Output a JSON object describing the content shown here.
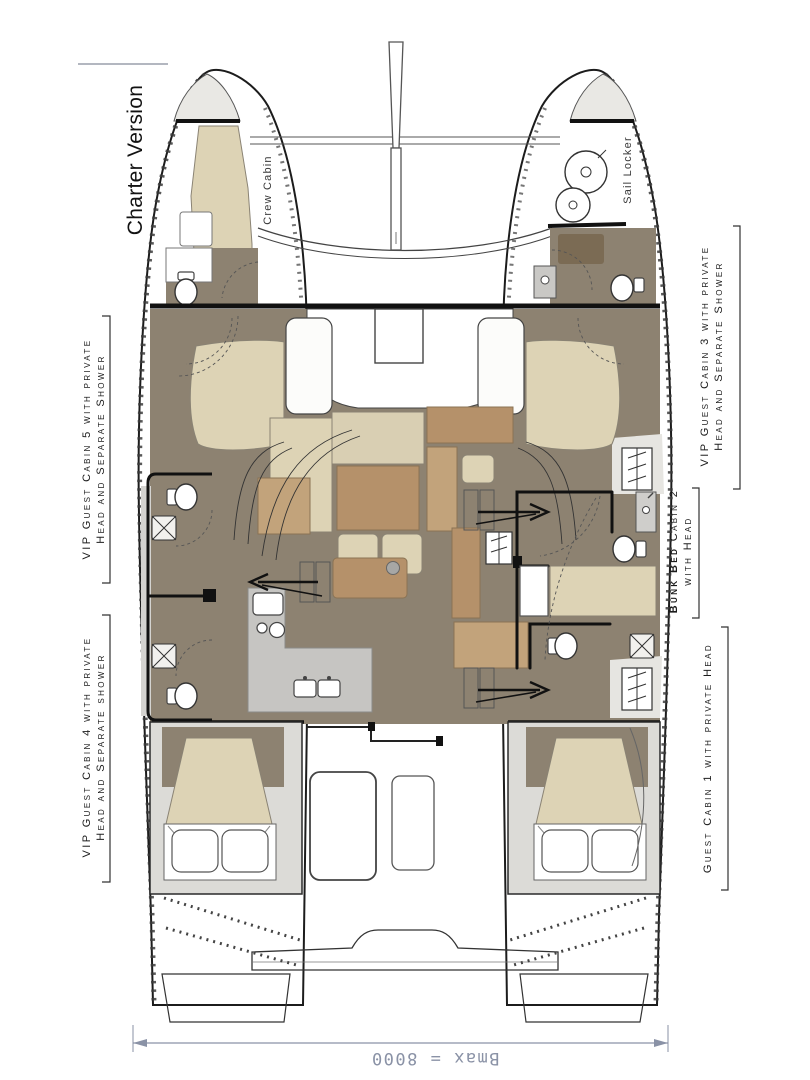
{
  "title": "Charter Version",
  "plan_notes": {
    "crew_cabin": "Crew Cabin",
    "sail_locker": "Sail Locker"
  },
  "cabin_labels": {
    "cabin5_line1": "VIP Guest Cabin 5 with private",
    "cabin5_line2": "Head and Separate Shower",
    "cabin4_line1": "VIP Guest Cabin 4 with private",
    "cabin4_line2": "Head and Separate shower",
    "cabin3_line1": "VIP Guest Cabin 3 with private",
    "cabin3_line2": "Head and Separate Shower",
    "cabin2_bold": "Bunk Bed",
    "cabin2_rest": " Cabin 2",
    "cabin2_line2": "with Head",
    "cabin1": "Guest Cabin 1 with private Head"
  },
  "dimension": {
    "label": "Bmax = 8000"
  },
  "colors": {
    "floor_taupe": "#8d8271",
    "furniture_cream": "#ddd3b5",
    "furniture_wood": "#b5916a",
    "furniture_wood_light": "#c2a37b",
    "counter_gray": "#c6c5c2",
    "deck_gray": "#e6e5e1",
    "outline": "#1c1c1c",
    "dimension_blue": "#8a92a6"
  }
}
